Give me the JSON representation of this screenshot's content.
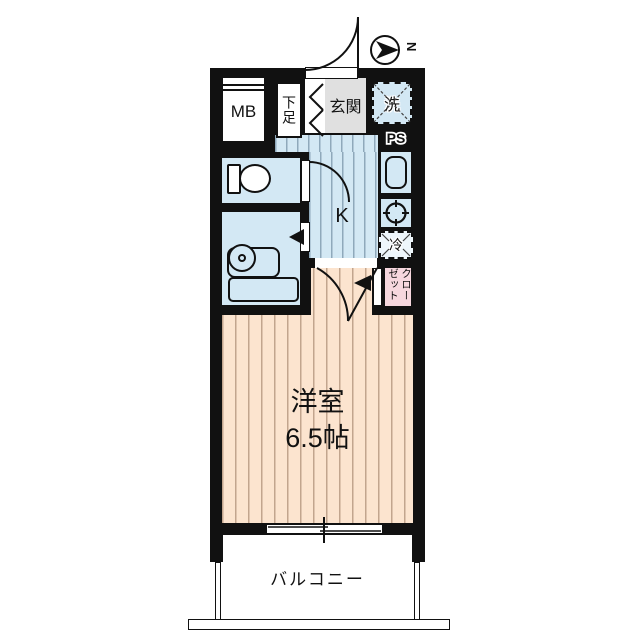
{
  "floorplan": {
    "compass": {
      "north_label": "N"
    },
    "labels": {
      "meter_box": "MB",
      "shoe_storage": "下足",
      "entrance": "玄関",
      "washer": "洗",
      "pipe_space": "PS",
      "kitchen": "K",
      "refrigerator": "冷",
      "closet": "クローゼット",
      "room_name": "洋室",
      "room_size": "6.5帖",
      "balcony": "バルコニー"
    },
    "colors": {
      "wall": "#111111",
      "water_area": "#d3e8f4",
      "room_floor": "#fce4cf",
      "entrance_floor": "#e0e0e0",
      "closet_fill": "#f6d7de"
    }
  }
}
